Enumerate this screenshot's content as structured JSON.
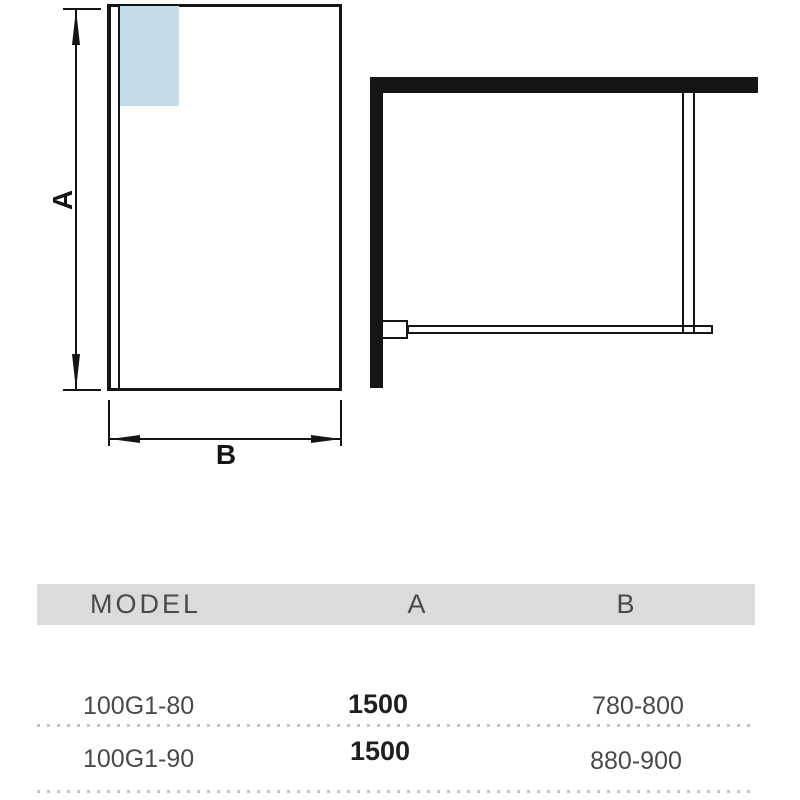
{
  "front_view": {
    "height_dim_label": "A",
    "width_dim_label": "B"
  },
  "table": {
    "headers": {
      "model": "MODEL",
      "a": "A",
      "b": "B"
    },
    "rows": [
      {
        "model": "100G1-80",
        "a": "1500",
        "b": "780-800"
      },
      {
        "model": "100G1-90",
        "a": "1500",
        "b": "880-900"
      }
    ]
  },
  "colors": {
    "wall_black": "#151515",
    "glass_blue": "#c4dcea",
    "header_bg": "#dbdbdb",
    "text_gray": "#4a4a4a"
  }
}
